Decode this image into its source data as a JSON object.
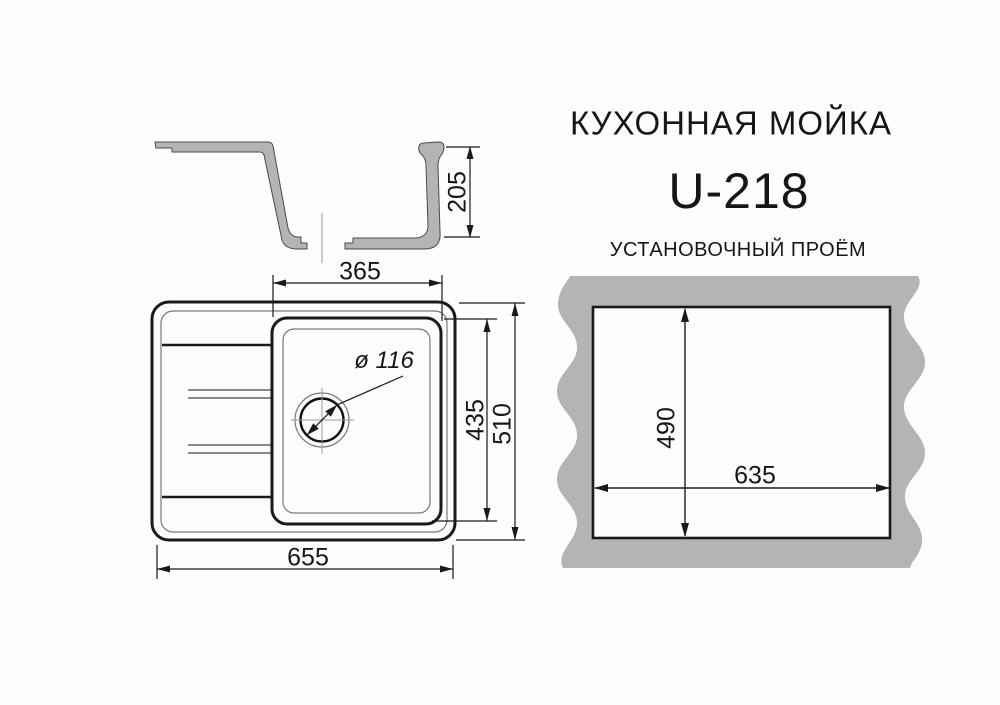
{
  "header": {
    "product_type": "КУХОННАЯ МОЙКА",
    "model": "U-218",
    "cutout_title": "УСТАНОВОЧНЫЙ ПРОЁМ"
  },
  "section_view": {
    "depth": "205"
  },
  "plan_view": {
    "bowl_width": "365",
    "bowl_length": "435",
    "overall_length": "655",
    "overall_width": "510",
    "drain_diameter": "ø 116"
  },
  "cutout_view": {
    "width": "635",
    "height": "490"
  },
  "colors": {
    "material_gray": "#b4b4b4",
    "line_dark": "#1a1a1a",
    "line_thin": "#666666",
    "background": "#fdfdfd"
  }
}
